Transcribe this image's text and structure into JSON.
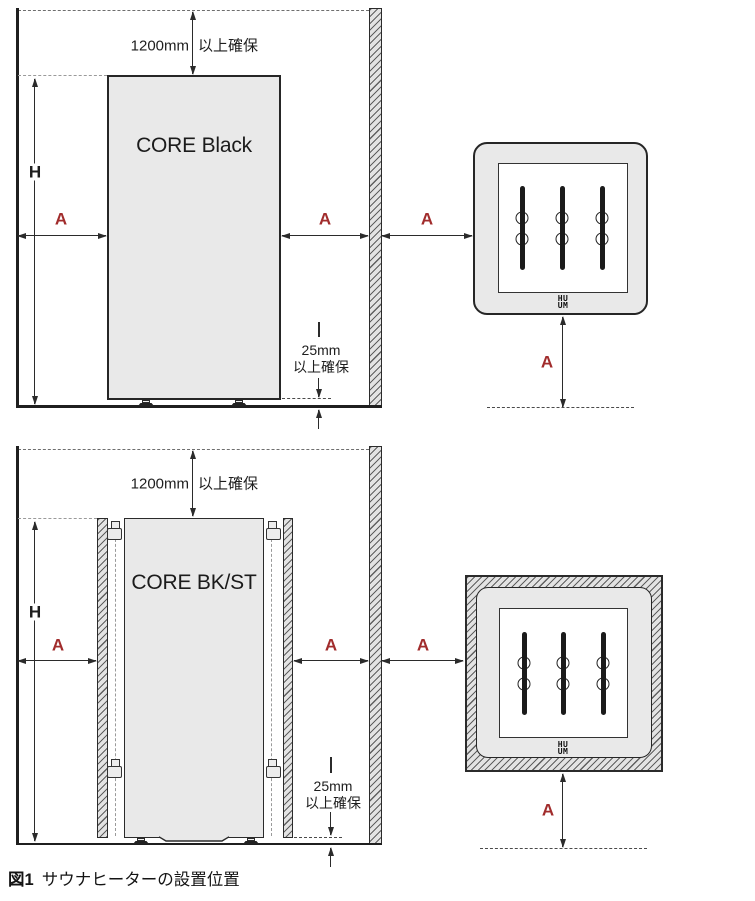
{
  "colors": {
    "dimension_accent_red": "#a12c2c",
    "line_dark": "#2b2b2b",
    "heater_fill": "#e9e9e9"
  },
  "dim_labels": {
    "height": "H",
    "clearance": "A"
  },
  "elevation_black": {
    "heater_name": "CORE Black",
    "top_clearance_value": "1200mm",
    "top_clearance_suffix": "以上確保",
    "floor_clearance_value": "25mm",
    "floor_clearance_suffix": "以上確保"
  },
  "elevation_bkst": {
    "heater_name": "CORE BK/ST",
    "top_clearance_value": "1200mm",
    "top_clearance_suffix": "以上確保",
    "floor_clearance_value": "25mm",
    "floor_clearance_suffix": "以上確保"
  },
  "top_views": {
    "logo_top": "HU",
    "logo_bottom": "UM"
  },
  "caption": {
    "figure_label": "図1",
    "figure_title": "サウナヒーターの設置位置"
  }
}
